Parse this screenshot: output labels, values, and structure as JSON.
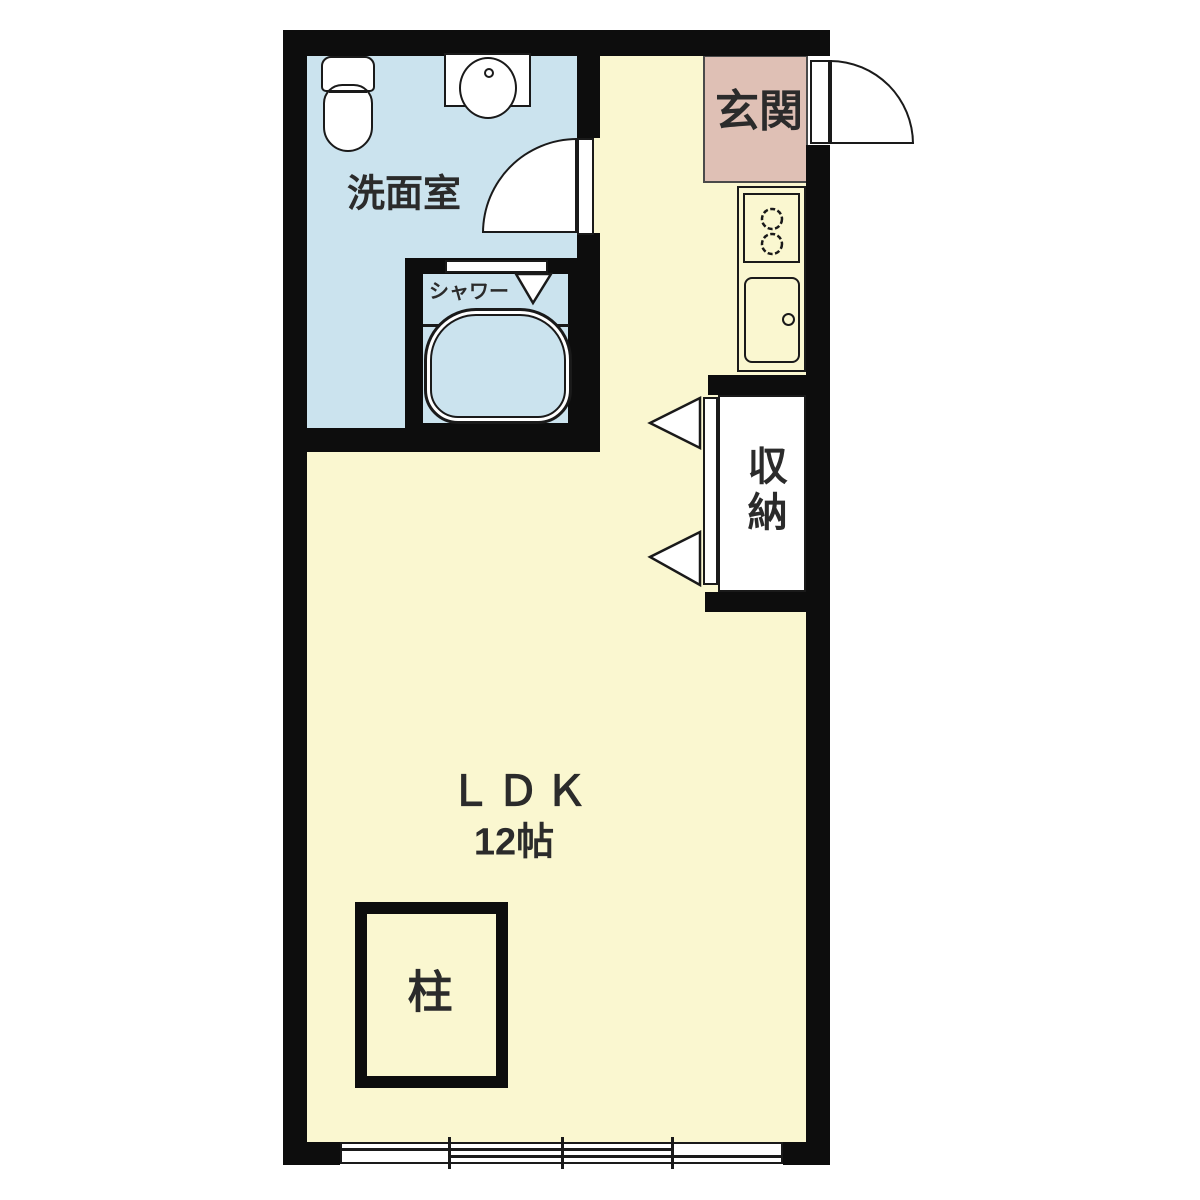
{
  "plan_type": "floorplan",
  "rooms": {
    "washroom": {
      "label": "洗面室"
    },
    "shower": {
      "label": "シャワー"
    },
    "entrance": {
      "label": "玄関"
    },
    "storage": {
      "label": "収納"
    },
    "ldk": {
      "label": "ＬＤＫ",
      "size": "12帖"
    },
    "pillar": {
      "label": "柱"
    }
  },
  "icons": [
    "toilet-icon",
    "washbasin-icon",
    "bathtub-icon",
    "stove-burners-icon",
    "kitchen-sink-icon",
    "hinged-door-arc-icon",
    "folding-door-triangle-icon",
    "sliding-window-icon"
  ],
  "colors": {
    "wall": "#0d0d0d",
    "floor": "#faf7d0",
    "wet_area": "#cbe3ee",
    "entrance": "#dfc0b5",
    "outline": "#1a1a1a",
    "text": "#2b2b2b",
    "fixture_fill": "#ffffff",
    "background": "#ffffff"
  }
}
